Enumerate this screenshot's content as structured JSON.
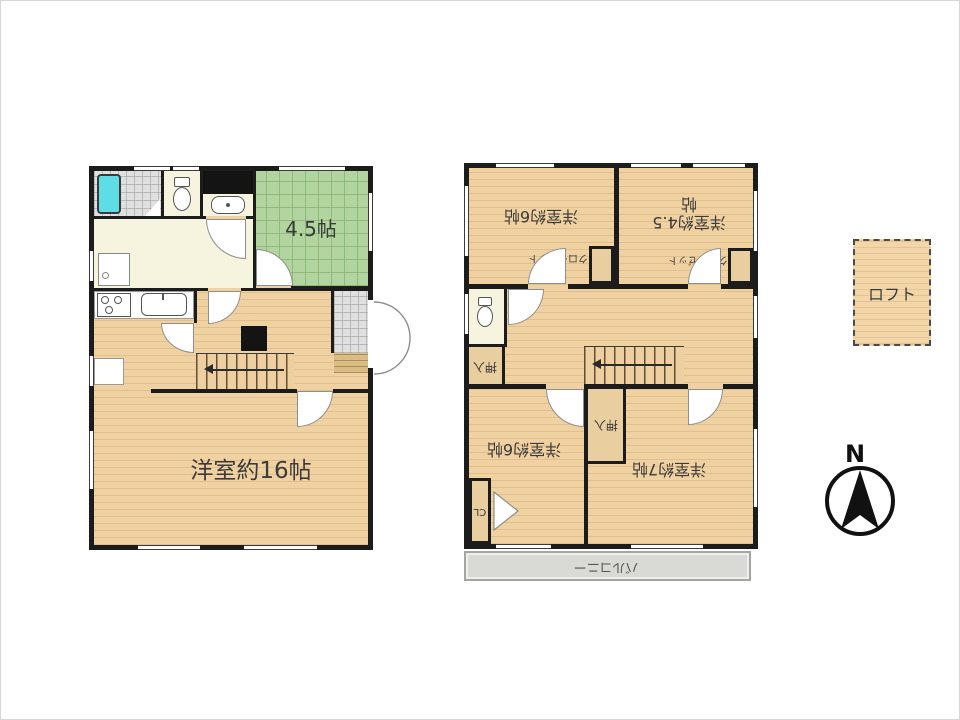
{
  "floor1": {
    "tatami_label": "4.5帖",
    "living_label": "洋室約16帖"
  },
  "floor2": {
    "room_nw_label": "洋室約6帖",
    "room_ne_label_line1": "洋室約4.5",
    "room_ne_label_line2": "帖",
    "closet_label": "クローゼット",
    "oshiire_label": "押入",
    "room_sw_label": "洋室約6帖",
    "room_se_label": "洋室約7帖",
    "cl_label": "CL",
    "balcony_label": "バルコニー"
  },
  "loft": {
    "label": "ロフト"
  },
  "compass": {
    "label": "N"
  },
  "colors": {
    "wall": "#1c1c1c",
    "wood_floor": "#f0d2a2",
    "tatami_green": "#b2d5a0",
    "washroom_cream": "#f6f3df",
    "bathtub_cyan": "#5fdde6",
    "entrance_tile": "#e0e0e0",
    "balcony_gray": "#d9d9d5"
  }
}
